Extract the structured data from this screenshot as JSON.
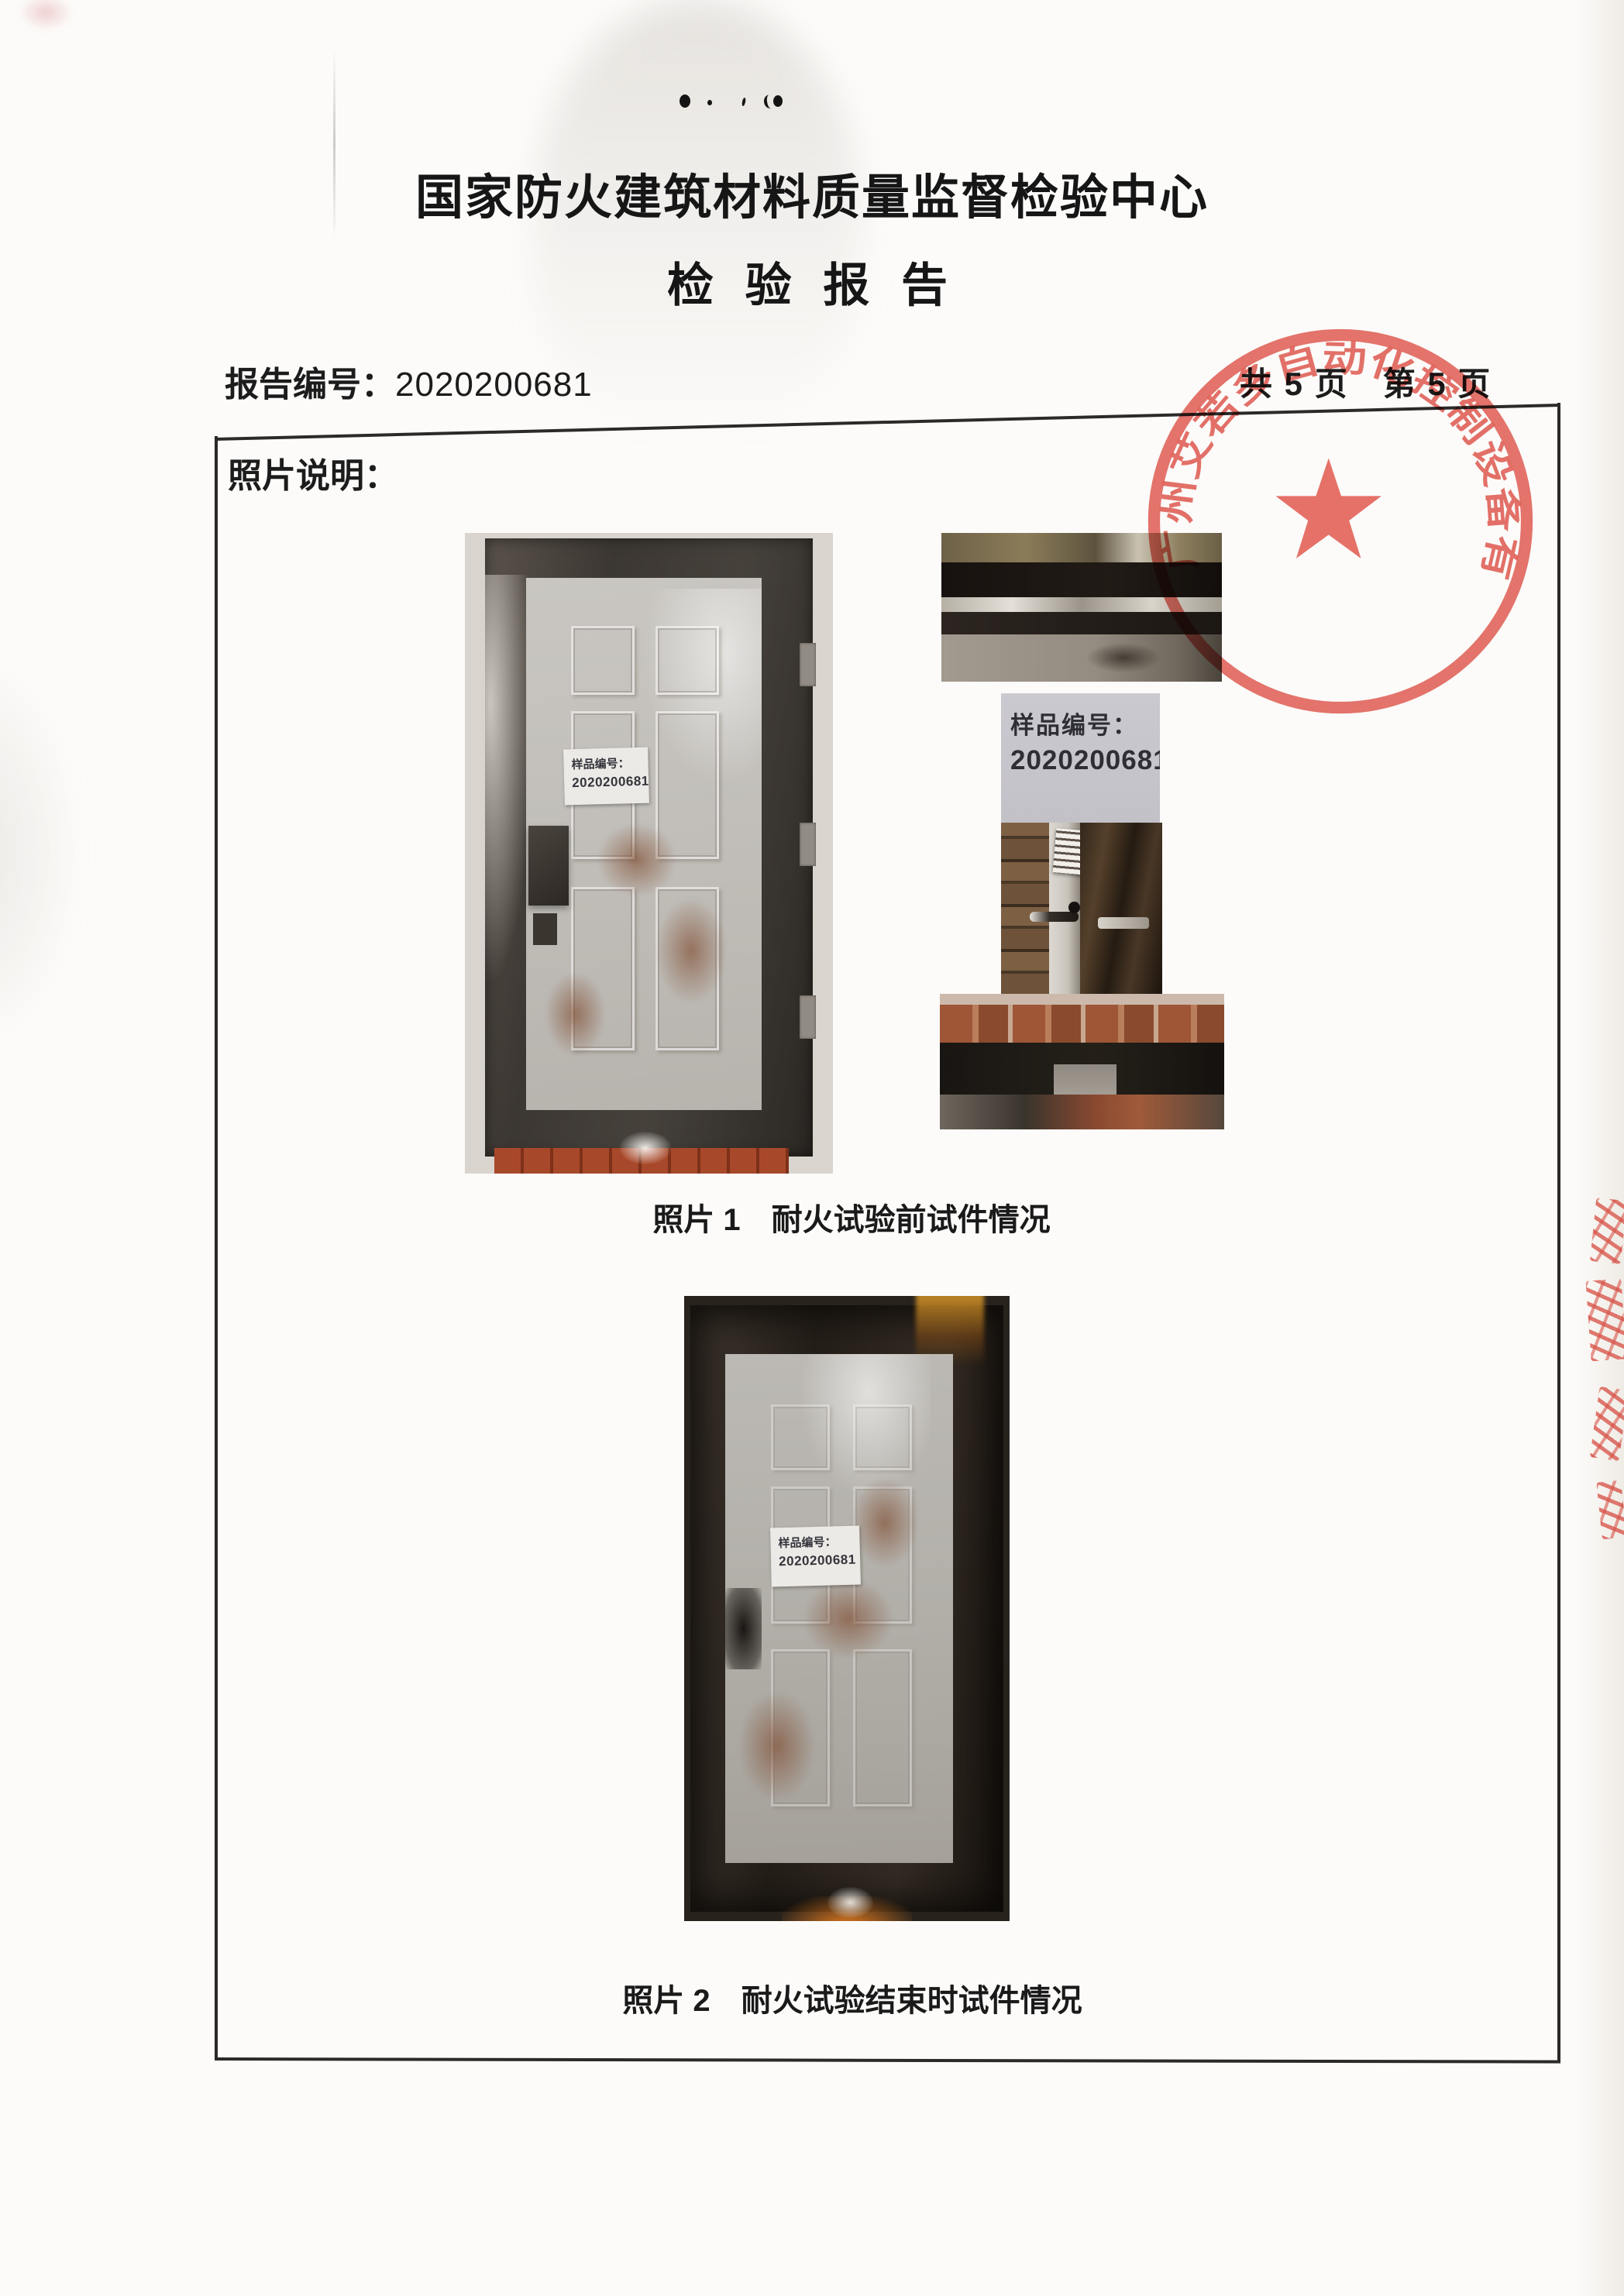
{
  "doc": {
    "title": "国家防火建筑材料质量监督检验中心",
    "subtitle": "检 验 报 告",
    "report_no_label": "报告编号：",
    "report_no": "2020200681",
    "pagination": "共 5 页　第 5 页",
    "section_label": "照片说明：",
    "captions": {
      "photo1": "照片 1　耐火试验前试件情况",
      "photo2": "照片 2　耐火试验结束时试件情况"
    },
    "sample_label": {
      "line1": "样品编号：",
      "line2": "2020200681"
    },
    "stamp": {
      "company": "广州艾若多自动化控制设备有限公司",
      "color": "#dd4439"
    }
  }
}
